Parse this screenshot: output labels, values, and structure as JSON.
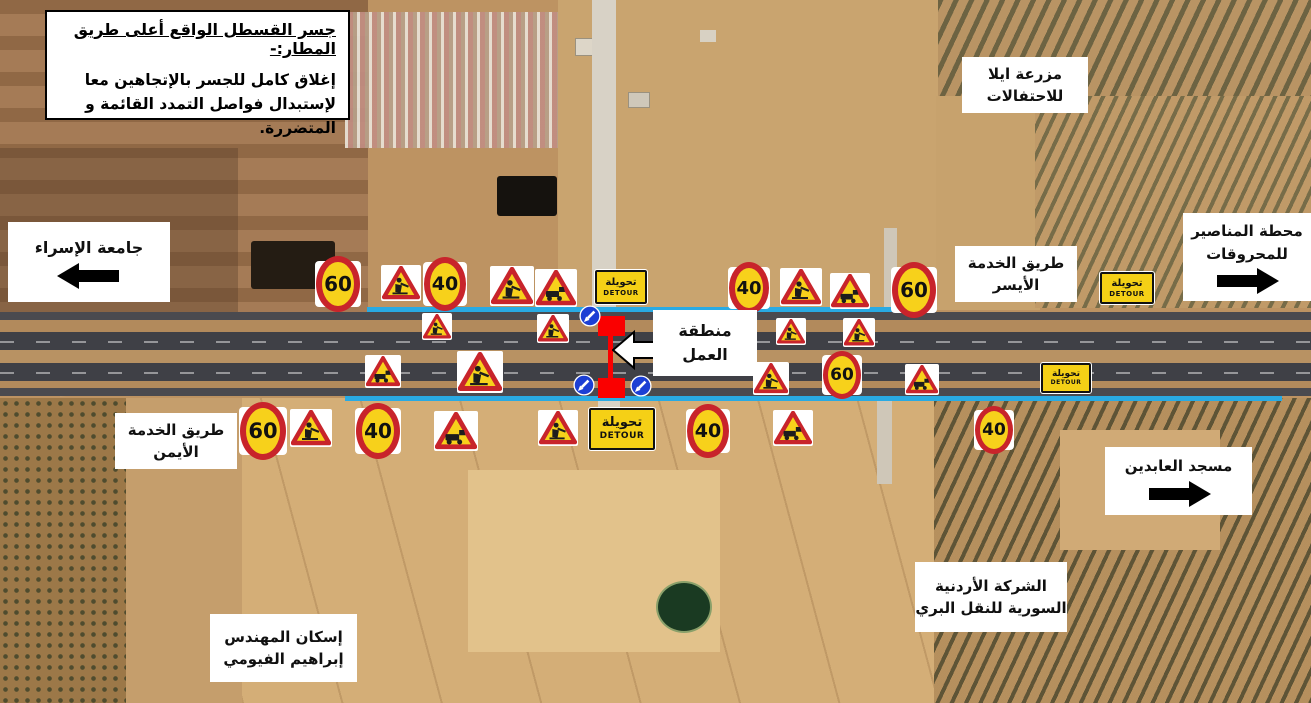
{
  "title_box": {
    "title": "جسر القسطل الواقع أعلى طريق المطار:-",
    "body": "إغلاق كامل للجسر بالإتجاهين معا لإستبدال فواصل التمدد القائمة و المتضررة."
  },
  "detour_sign_text": {
    "ar": "تحويلة",
    "en": "DETOUR"
  },
  "labels": [
    {
      "id": "isra-university",
      "text": "جامعة الإسراء",
      "arrow": "left",
      "x": 8,
      "y": 222,
      "w": 162,
      "h": 80,
      "fs": 16
    },
    {
      "id": "ayla-farm",
      "text": "مزرعة ايلا\nللاحتفالات",
      "arrow": "",
      "x": 962,
      "y": 57,
      "w": 126,
      "h": 56,
      "fs": 15
    },
    {
      "id": "manaseer-fuel-station",
      "text": "محطة المناصير\nللمحروقات",
      "arrow": "right",
      "x": 1183,
      "y": 213,
      "w": 128,
      "h": 88,
      "fs": 15
    },
    {
      "id": "left-service-road",
      "text": "طريق الخدمة\nالأيسر",
      "arrow": "",
      "x": 955,
      "y": 246,
      "w": 122,
      "h": 56,
      "fs": 15
    },
    {
      "id": "work-area",
      "text": "منطقة\nالعمل",
      "arrow": "",
      "x": 653,
      "y": 310,
      "w": 104,
      "h": 66,
      "fs": 16
    },
    {
      "id": "right-service-road",
      "text": "طريق الخدمة\nالأيمن",
      "arrow": "",
      "x": 115,
      "y": 413,
      "w": 122,
      "h": 56,
      "fs": 15
    },
    {
      "id": "abideen-mosque",
      "text": "مسجد العابدين",
      "arrow": "right",
      "x": 1105,
      "y": 447,
      "w": 147,
      "h": 68,
      "fs": 15
    },
    {
      "id": "jordanian-syrian-transport",
      "text": "الشركة الأردنية\nالسورية للنقل البري",
      "arrow": "",
      "x": 915,
      "y": 562,
      "w": 152,
      "h": 70,
      "fs": 15
    },
    {
      "id": "fayoumi-housing",
      "text": "إسكان المهندس\nإبراهيم الفيومي",
      "arrow": "",
      "x": 210,
      "y": 614,
      "w": 147,
      "h": 68,
      "fs": 15
    }
  ],
  "signs": [
    {
      "kind": "speed",
      "value": "60",
      "x": 337,
      "y": 283,
      "s": 44
    },
    {
      "kind": "worker",
      "x": 400,
      "y": 282,
      "s": 38
    },
    {
      "kind": "speed",
      "value": "40",
      "x": 444,
      "y": 283,
      "s": 42
    },
    {
      "kind": "worker",
      "x": 511,
      "y": 285,
      "s": 42
    },
    {
      "kind": "equip",
      "x": 555,
      "y": 287,
      "s": 40
    },
    {
      "kind": "detour",
      "x": 619,
      "y": 285,
      "w": 48,
      "h": 30
    },
    {
      "kind": "speed",
      "value": "40",
      "x": 748,
      "y": 287,
      "s": 40
    },
    {
      "kind": "worker",
      "x": 800,
      "y": 286,
      "s": 40
    },
    {
      "kind": "equip",
      "x": 849,
      "y": 290,
      "s": 38
    },
    {
      "kind": "speed",
      "value": "60",
      "x": 913,
      "y": 289,
      "s": 44
    },
    {
      "kind": "detour",
      "x": 1125,
      "y": 286,
      "w": 50,
      "h": 28
    },
    {
      "kind": "worker",
      "x": 436,
      "y": 325,
      "s": 28
    },
    {
      "kind": "worker",
      "x": 552,
      "y": 327,
      "s": 30
    },
    {
      "kind": "worker",
      "x": 790,
      "y": 330,
      "s": 28
    },
    {
      "kind": "worker",
      "x": 858,
      "y": 331,
      "s": 30
    },
    {
      "kind": "equip",
      "x": 382,
      "y": 370,
      "s": 34
    },
    {
      "kind": "worker",
      "x": 479,
      "y": 371,
      "s": 44
    },
    {
      "kind": "worker",
      "x": 770,
      "y": 377,
      "s": 34
    },
    {
      "kind": "speed",
      "value": "60",
      "x": 841,
      "y": 374,
      "s": 38
    },
    {
      "kind": "equip",
      "x": 921,
      "y": 378,
      "s": 32
    },
    {
      "kind": "detour",
      "x": 1064,
      "y": 376,
      "w": 46,
      "h": 26
    },
    {
      "kind": "speed",
      "value": "60",
      "x": 262,
      "y": 430,
      "s": 46
    },
    {
      "kind": "worker",
      "x": 310,
      "y": 427,
      "s": 40
    },
    {
      "kind": "speed",
      "value": "40",
      "x": 377,
      "y": 430,
      "s": 44
    },
    {
      "kind": "equip",
      "x": 455,
      "y": 430,
      "s": 42
    },
    {
      "kind": "worker",
      "x": 557,
      "y": 427,
      "s": 38
    },
    {
      "kind": "detour",
      "x": 620,
      "y": 427,
      "w": 62,
      "h": 38
    },
    {
      "kind": "speed",
      "value": "40",
      "x": 707,
      "y": 430,
      "s": 42
    },
    {
      "kind": "equip",
      "x": 792,
      "y": 427,
      "s": 38
    },
    {
      "kind": "speed",
      "value": "40",
      "x": 993,
      "y": 429,
      "s": 38
    },
    {
      "kind": "mandatory",
      "x": 590,
      "y": 316,
      "s": 22
    },
    {
      "kind": "mandatory",
      "x": 584,
      "y": 385,
      "s": 22
    },
    {
      "kind": "mandatory",
      "x": 641,
      "y": 386,
      "s": 22
    }
  ],
  "colors": {
    "route_highlight": "#29aae3",
    "work_zone_red": "#fa0000",
    "sign_yellow": "#f7d11b",
    "sign_red_ring": "#c8242b",
    "detour_yellow": "#f5d016",
    "mandatory_blue": "#1c3fd4"
  }
}
